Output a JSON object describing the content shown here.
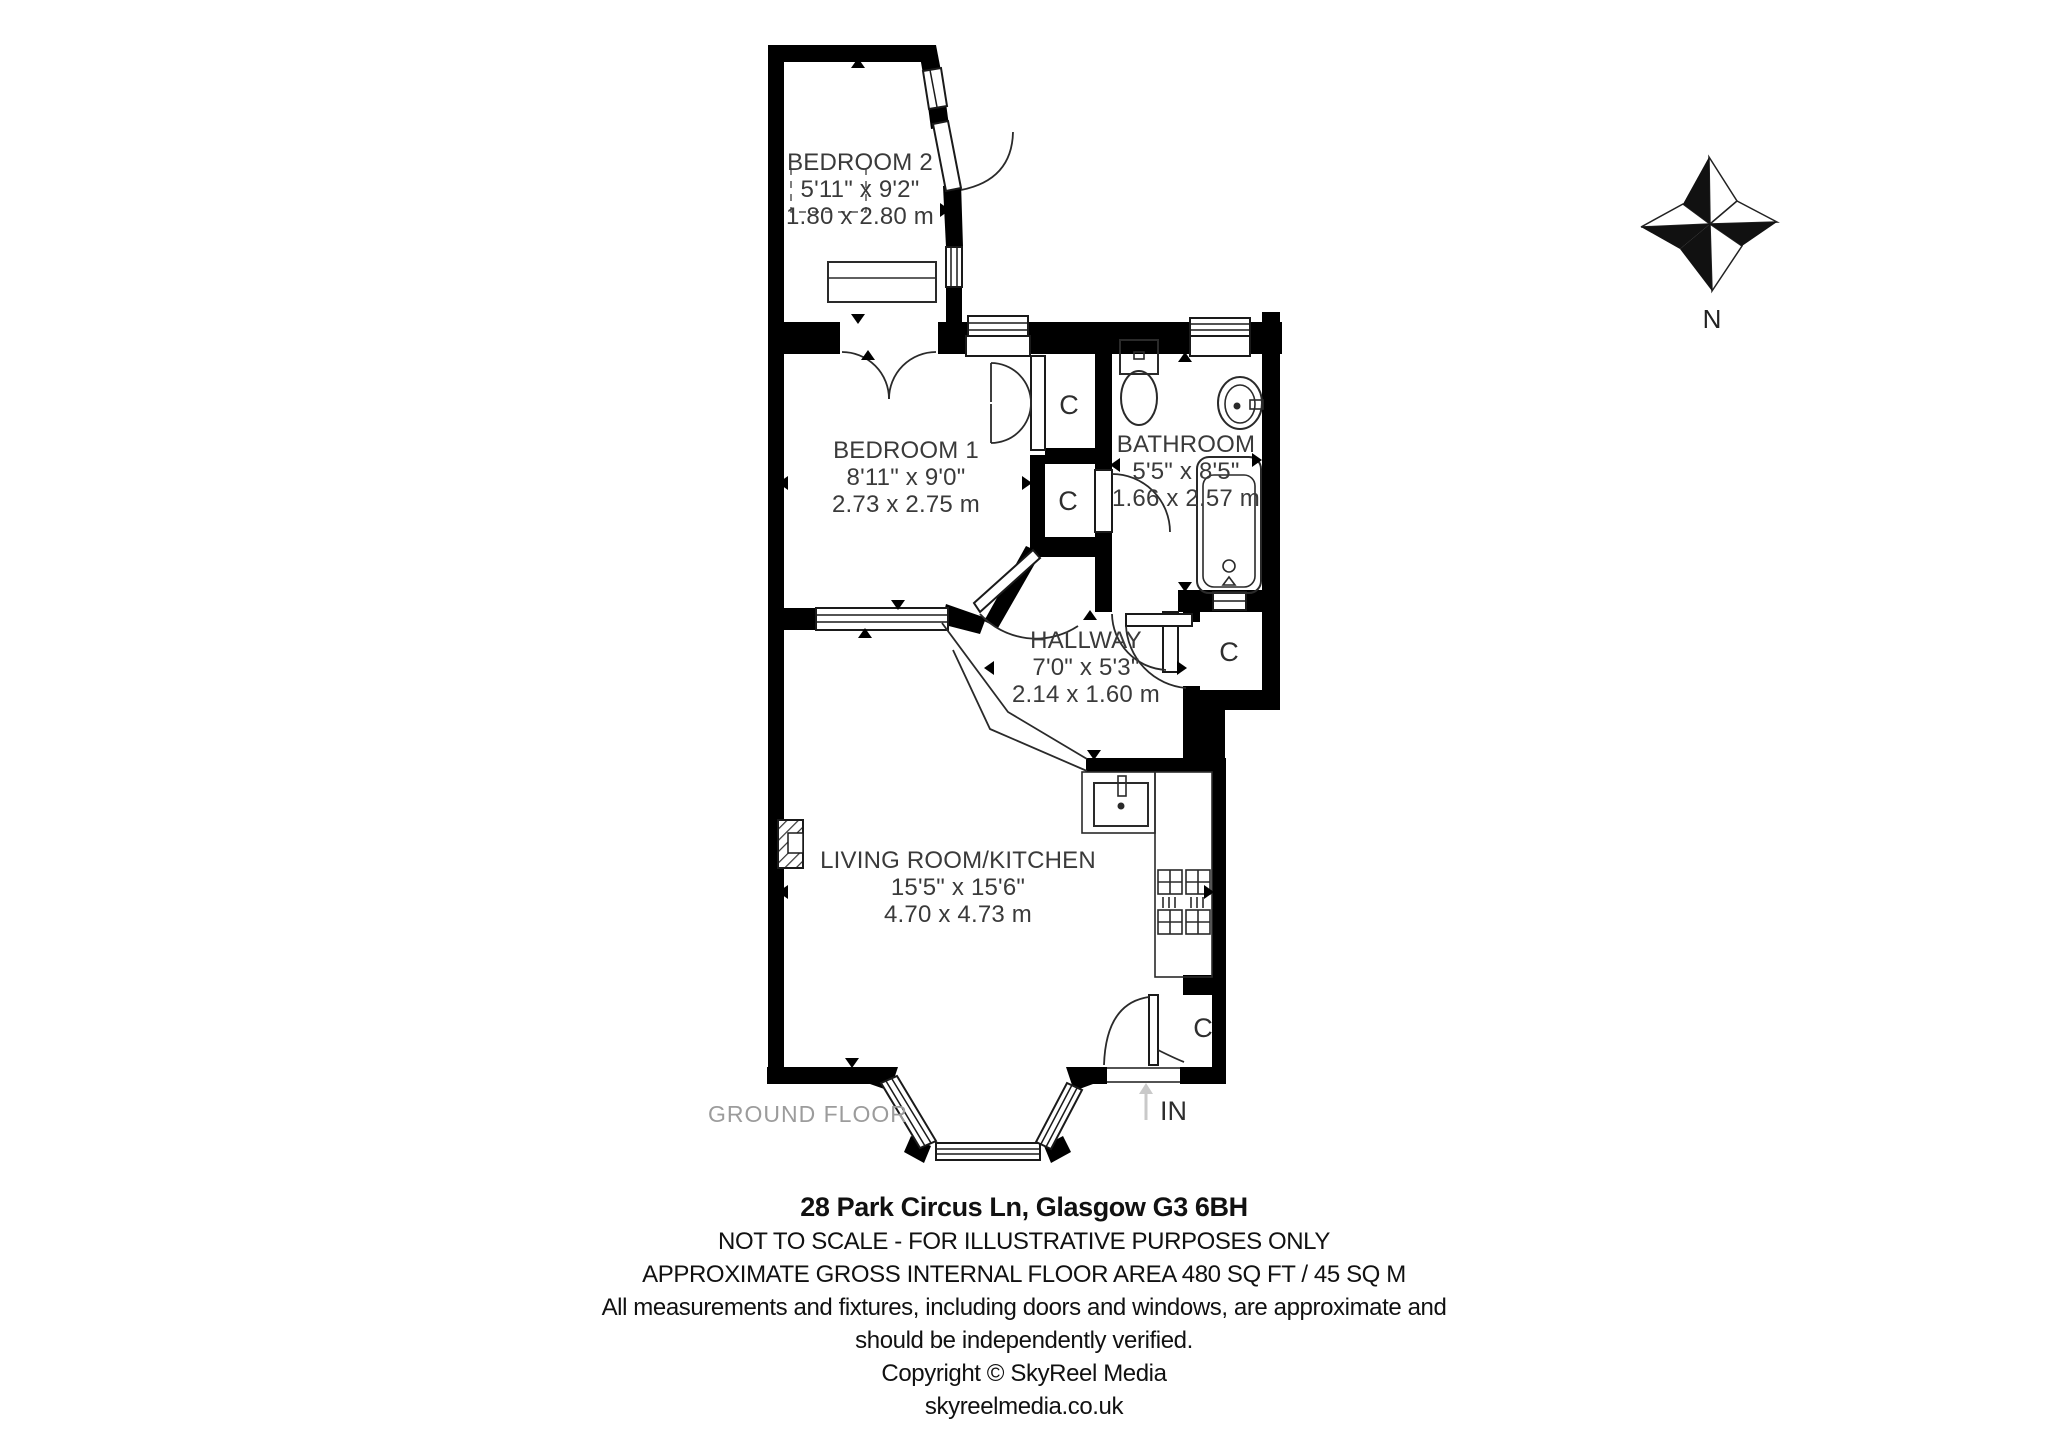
{
  "rooms": [
    {
      "id": "bedroom-2",
      "name": "BEDROOM 2",
      "size_imperial": "5'11\" x 9'2\"",
      "size_metric": "1.80 x 2.80 m"
    },
    {
      "id": "bedroom-1",
      "name": "BEDROOM 1",
      "size_imperial": "8'11\" x 9'0\"",
      "size_metric": "2.73 x 2.75 m"
    },
    {
      "id": "bathroom",
      "name": "BATHROOM",
      "size_imperial": "5'5\" x 8'5\"",
      "size_metric": "1.66 x 2.57 m"
    },
    {
      "id": "hallway",
      "name": "HALLWAY",
      "size_imperial": "7'0\" x 5'3\"",
      "size_metric": "2.14 x 1.60 m"
    },
    {
      "id": "living-room-kitchen",
      "name": "LIVING ROOM/KITCHEN",
      "size_imperial": "15'5\" x 15'6\"",
      "size_metric": "4.70 x 4.73 m"
    }
  ],
  "closet_label": "C",
  "entrance_label": "IN",
  "floor_label": "GROUND FLOOR",
  "compass": {
    "north_label": "N"
  },
  "footer": {
    "address": "28 Park Circus Ln, Glasgow G3 6BH",
    "scale_note": "NOT TO SCALE - FOR ILLUSTRATIVE PURPOSES ONLY",
    "area_note": "APPROXIMATE GROSS INTERNAL FLOOR AREA 480 SQ FT / 45 SQ M",
    "disclaimer_1": "All measurements and fixtures, including doors and windows, are approximate and",
    "disclaimer_2": "should be independently verified.",
    "copyright": "Copyright © SkyReel Media",
    "website": "skyreelmedia.co.uk"
  },
  "colors": {
    "wall": "#000000",
    "room_text": "#3a3a3a",
    "muted_text": "#9c9c9c",
    "footer_text": "#111111",
    "entry_arrow": "#c9c9c9"
  }
}
